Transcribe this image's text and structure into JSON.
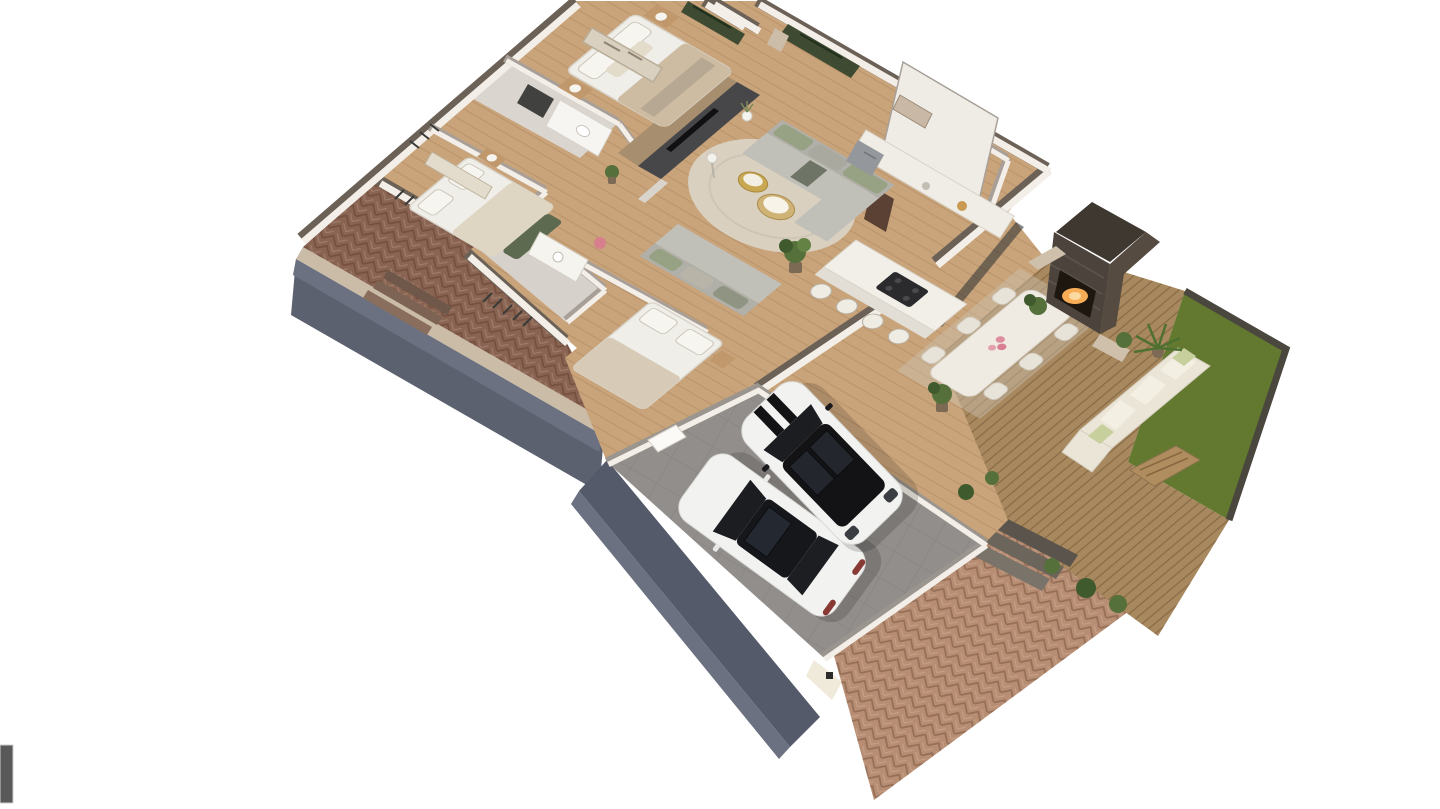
{
  "page": {
    "background": "#ffffff"
  },
  "scrollbar": {
    "thumb_color": "#595959",
    "thumb_border": "#cfcfcf"
  },
  "render": {
    "type": "3d-floorplan-isometric-cutaway",
    "description": "Photorealistic 3D dollhouse cutaway floor plan of a single-storey house viewed from above at an angle: three bedrooms and two bathrooms on the left, open living room with media wall and round rug in the center, kitchen with island and bar stools, entry hall, outdoor dining pavilion with stone fireplace, wood deck with outdoor lounge and lawn on the right, double garage with a white sedan and a white SUV with black roof at the bottom, herringbone brick patio on the west side and a large herringbone brick driveway at the bottom right, all sitting on a blue-gray concrete plinth.",
    "rooms": [
      "master-bedroom",
      "master-bathroom",
      "bedroom-2",
      "bathroom-2",
      "bedroom-3",
      "hallway",
      "living-room",
      "kitchen",
      "entry",
      "dining-pavilion",
      "garage"
    ],
    "exterior_areas": [
      "west-brick-patio",
      "south-brick-driveway",
      "wood-deck",
      "lawn",
      "outdoor-fireplace",
      "garden-steps"
    ],
    "vehicles": [
      "white-sedan",
      "white-suv-black-roof"
    ],
    "palette": {
      "background": "#ffffff",
      "wood_floor": "#c9a47b",
      "wall_white": "#f3efe8",
      "wall_cap_ext": "#6b6157",
      "wall_cap_int": "#a8a098",
      "bath_tile": "#dad6cf",
      "brick_dark": "#8a6452",
      "brick_light": "#b78e73",
      "curb": "#cabca7",
      "plinth": "#5c6170",
      "garage_wall_face": "#545a6a",
      "garage_floor": "#918e8b",
      "grass": "#63792f",
      "grass_edge": "#4a473f",
      "deck": "#a8885e",
      "stone": "#4c443c",
      "stone_top": "#3e3831",
      "fire_glow": "#f6ad55",
      "window_glass": "#3e4a31",
      "charcoal_wall": "#47474a",
      "media_wood": "#a78e6e",
      "rug": "#d9d0c0",
      "sofa": "#c0bfb8",
      "sofa_back": "#b0afa8",
      "cushion_green": "#97a183",
      "gold": "#c8a852",
      "marble": "#efeae2",
      "chair": "#e8e3d8",
      "outdoor_sofa": "#eae5d7",
      "outdoor_pillow": "#c7d09c",
      "table_wood": "#b08d5e",
      "car_white": "#f2f2f1",
      "car_glass": "#1b1d21",
      "car_roof_black": "#131315",
      "bed_white": "#efeee9",
      "bed_beige": "#cdbba2",
      "bench_green": "#5e6a50",
      "nightstand": "#c0986c",
      "art_beige": "#d9d0bf",
      "door_brown": "#5b4034",
      "plant_green": "#55703a",
      "plant_dark": "#3f5a2c",
      "pot": "#7c6a55",
      "steps_dark": "#5a544c"
    }
  }
}
